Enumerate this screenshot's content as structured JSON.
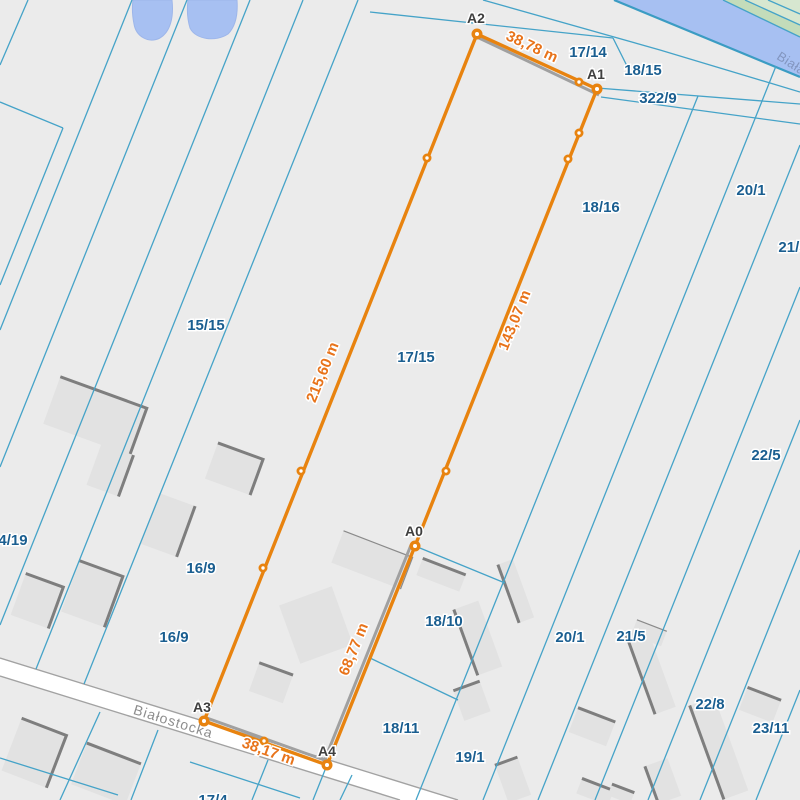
{
  "map": {
    "street": {
      "name": "Białostocka"
    },
    "river": {
      "name": "Biała"
    },
    "vertices": [
      "A0",
      "A1",
      "A2",
      "A3",
      "A4"
    ],
    "measurements": [
      "38,78 m",
      "143,07 m",
      "215,60 m",
      "68,77 m",
      "38,17 m"
    ],
    "parcel_labels": [
      "17/14",
      "18/15",
      "322/9",
      "18/16",
      "20/1",
      "21/5",
      "15/15",
      "17/15",
      "22/5",
      "4/19",
      "16/9",
      "16/9",
      "18/10",
      "20/1",
      "21/5",
      "18/11",
      "19/1",
      "22/8",
      "23/11",
      "17/4"
    ],
    "colors": {
      "accent_orange": "#e8830f",
      "measure_text": "#e8731a",
      "parcel_line": "#45a3c8",
      "parcel_label": "#1a5e90",
      "water": "#a7c0f2",
      "green_light": "#d7e7d0",
      "green_dark": "#c3dcba",
      "land": "#ebebeb",
      "street_fill": "#ffffff",
      "building_fill": "#e2e2e2",
      "building_edge": "#7e7e7e"
    }
  }
}
